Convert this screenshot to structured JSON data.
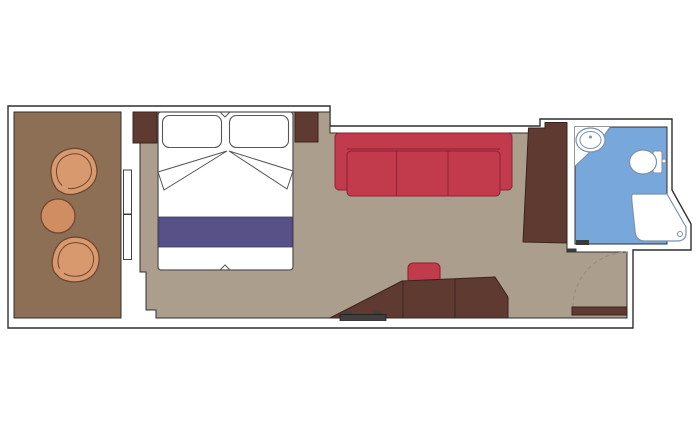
{
  "plan": {
    "kind": "cabin-floor-plan",
    "rooms": [
      {
        "name": "balcony",
        "furniture": [
          "tub-chair",
          "tub-chair",
          "round-table"
        ]
      },
      {
        "name": "bedroom",
        "furniture": [
          "double-bed",
          "pillow-left",
          "pillow-right",
          "bed-runner",
          "nightstand-left",
          "nightstand-right"
        ]
      },
      {
        "name": "living-area",
        "furniture": [
          "three-seat-sofa",
          "stool",
          "desk",
          "luggage-rack",
          "wardrobe"
        ]
      },
      {
        "name": "bathroom",
        "furniture": [
          "washbasin",
          "toilet",
          "corner-shower"
        ]
      },
      {
        "name": "entry-hall",
        "furniture": [
          "entrance-door"
        ]
      }
    ],
    "doors": [
      "sliding-balcony-door",
      "bathroom-door",
      "entrance-door"
    ]
  },
  "colors": {
    "background": "#ffffff",
    "wall_fill": "#ffffff",
    "wall_line": "#2f2f2f",
    "balcony_floor": "#8d6f55",
    "room_floor": "#ac9e8c",
    "bathroom_floor": "#78a7db",
    "fixture_fill": "#ffffff",
    "fixture_line": "#7b92ab",
    "wood": "#5e3a31",
    "wood_line": "#39241e",
    "sofa_red": "#c23b4c",
    "sofa_line": "#8c2133",
    "bed_fill": "#ffffff",
    "bed_line": "#55565a",
    "bed_runner": "#575187",
    "runner_line": "#3c3866",
    "chair_orange": "#d9996f",
    "chair_line": "#6e4830",
    "table_orange": "#cf8d61",
    "rack_dark": "#3f3f3f",
    "rack_line": "#1f1f1f",
    "door_arc": "#9a8c7b",
    "door_mark": "#3a3a3a"
  }
}
